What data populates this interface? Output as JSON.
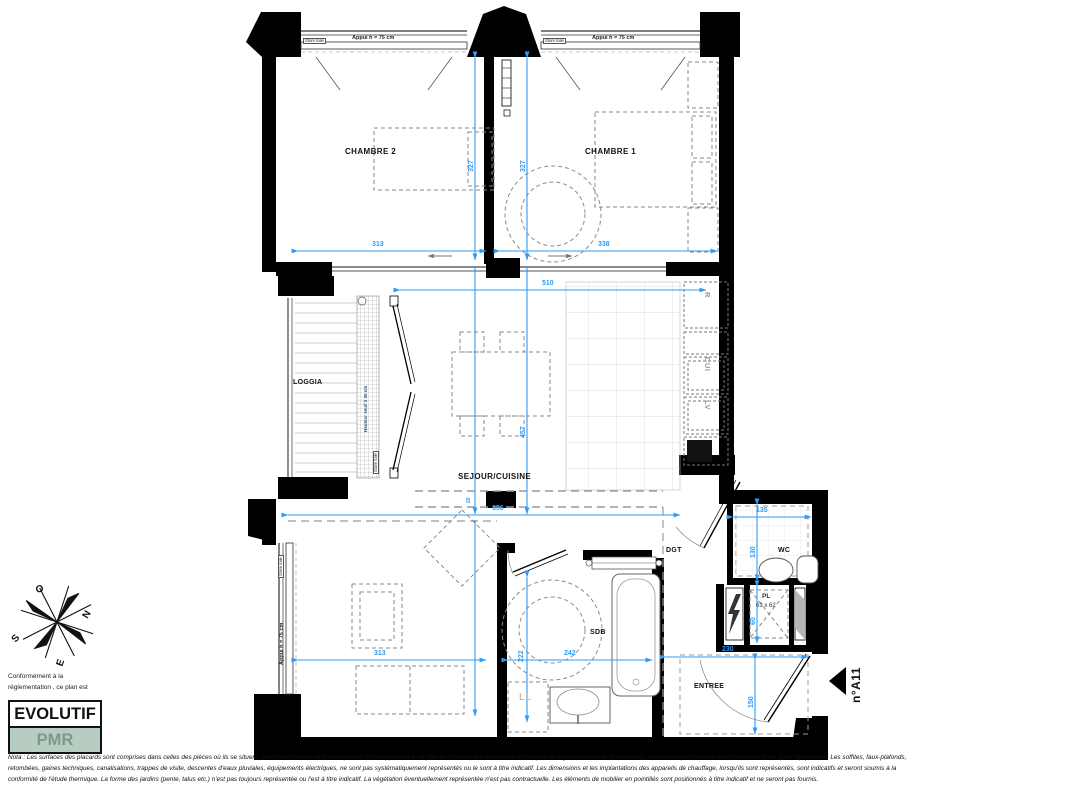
{
  "plan": {
    "rooms": {
      "chambre2": "CHAMBRE 2",
      "chambre1": "CHAMBRE 1",
      "loggia": "LOGGIA",
      "sejour_cuisine": "SEJOUR/CUISINE",
      "sdb": "SDB",
      "dgt": "DGT",
      "wc": "WC",
      "entree": "ENTREE"
    },
    "appliances": {
      "refrigerateur": "R",
      "cuisiniere": "CUI",
      "lave_vaisselle": "LV",
      "lave_linge": "LL",
      "placard": "PL",
      "placard_size": "63 x 62"
    },
    "windows": {
      "store_toile": "Store toile",
      "appui": "Appui h = 75 cm",
      "seuil": "Hauteur seuil à 35 cm"
    },
    "dims": {
      "chambre2_width": "313",
      "chambre1_width": "338",
      "chambre2_depth": "327",
      "chambre1_depth": "327",
      "sejour_width": "510",
      "sejour_depth": "457",
      "sejour_total_width": "656",
      "beam": "20",
      "wc_width": "135",
      "wc_depth": "130",
      "salon_width": "313",
      "sdb_width": "242",
      "sdb_depth": "222",
      "pl_depth": "60",
      "entree_width": "230",
      "entree_depth": "150"
    },
    "compass": {
      "o": "O",
      "n": "N",
      "e": "E",
      "s": "S"
    },
    "legend": {
      "intro_line1": "Conformément à la",
      "intro_line2": "réglementation , ce plan est",
      "evolutif": "EVOLUTIF",
      "pmr": "PMR"
    },
    "marker": {
      "lot": "n°A11"
    },
    "nota": {
      "line1": "Nota : Les surfaces des placards sont comprises dans celles des pièces où ils se situent. Des modifications sont susceptibles d'être apportées à ce plan en fonction des nécessités techniques et réglementaires de la réalisation, tant en ce qui concerne les dimensions libres que l'équipement. Les soffites, faux-plafonds,",
      "line2": "retombées, gaines techniques, canalisations, trappes de visite, descentes d'eaux pluviales, équipements électriques, ne sont pas systématiquement représentés ou le sont à titre indicatif. Les dimensions et les implantations des appareils de chauffage, lorsqu'ils sont représentés, sont indicatifs et seront soumis à la",
      "line3": "conformité de l'étude thermique. La forme des jardins (pente, talus etc.) n'est pas toujours représentée ou l'est à titre indicatif. La végétation éventuellement représentée n'est pas contractuelle. Les éléments de mobilier en pointillés sont positionnés à titre indicatif et ne seront pas fournis."
    },
    "colors": {
      "dim_blue": "#2f9bf6",
      "wall": "#000000",
      "pmr_bg": "#b7cdc2",
      "pmr_text": "#80988c"
    }
  }
}
